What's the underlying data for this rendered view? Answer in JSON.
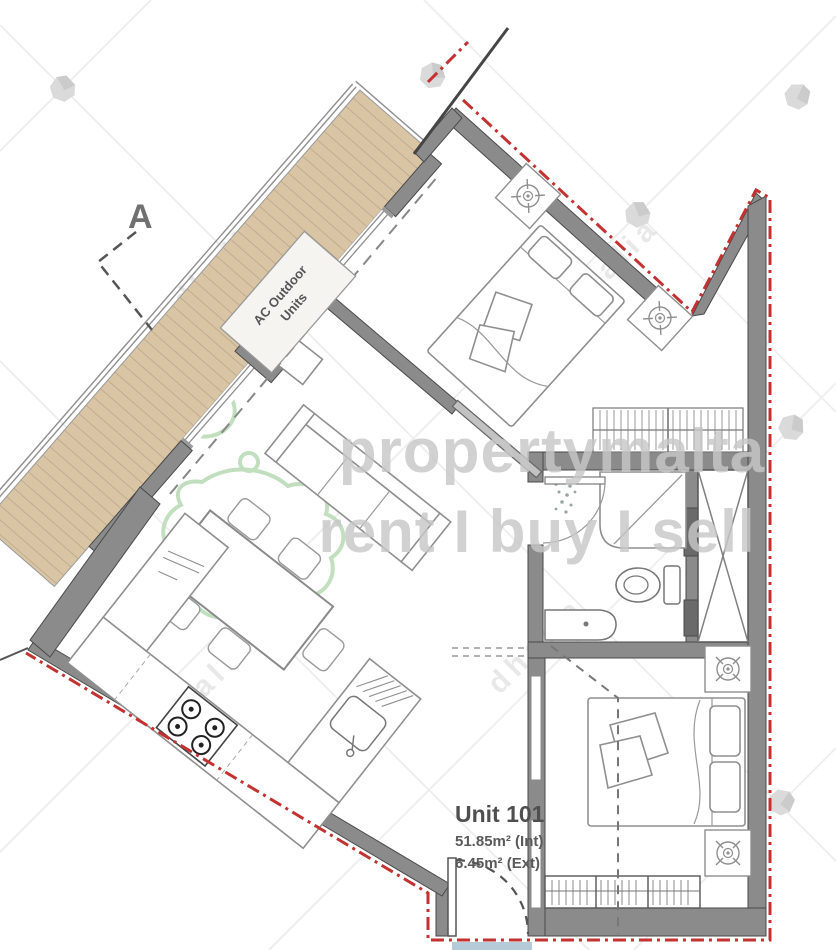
{
  "page": {
    "width_px": 836,
    "height_px": 950,
    "background": "#ffffff"
  },
  "title_block": {
    "unit_title": "Unit 101",
    "area_internal": "51.85m² (Int)",
    "area_external": "6.45m² (Ext)"
  },
  "annotations": {
    "section_marker": "A",
    "ac_units_line1": "AC Outdoor",
    "ac_units_line2": "Units"
  },
  "watermark": {
    "brand_line1": "propertymalta",
    "brand_line2": "rent I buy I sell",
    "diagonal_text": "dhalia"
  },
  "colors": {
    "boundary_red": "#c43131",
    "wall_gray": "#8b8b8b",
    "wall_dark": "#6a6a6a",
    "deck_tan": "#d9c5a4",
    "deck_gap": "#b9a78a",
    "logo_green": "#b7dab4",
    "brand_gray": "#c7c7c7",
    "blue_fragment": "#b5cbd8"
  }
}
